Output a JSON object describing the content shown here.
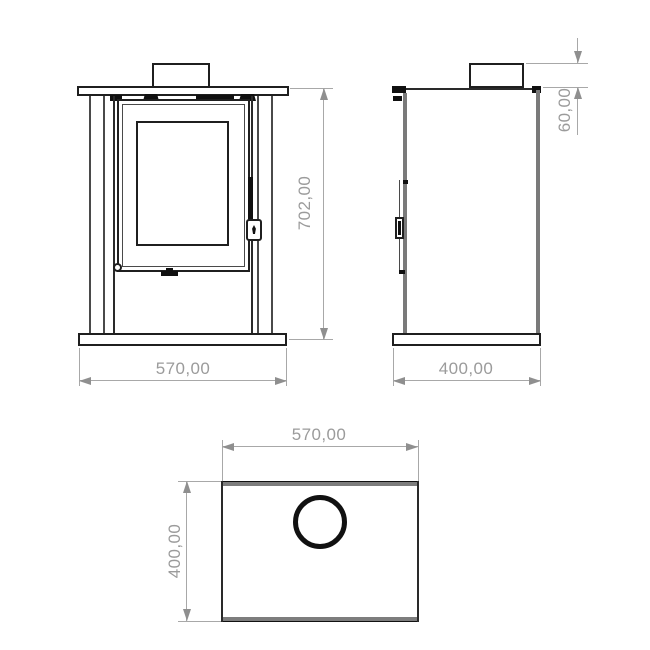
{
  "drawing": {
    "title": "stove-technical-drawing",
    "colors": {
      "outline": "#1f1f1f",
      "panel_gray": "#7a7a7a",
      "dimension_line": "#a8a8a8",
      "dimension_text": "#9b9b9b",
      "background": "#ffffff"
    },
    "front_view": {
      "height_dim": "702,00",
      "width_dim": "570,00"
    },
    "side_view": {
      "collar_height_dim": "60,00",
      "depth_dim": "400,00"
    },
    "top_view": {
      "width_dim": "570,00",
      "depth_dim": "400,00"
    }
  }
}
